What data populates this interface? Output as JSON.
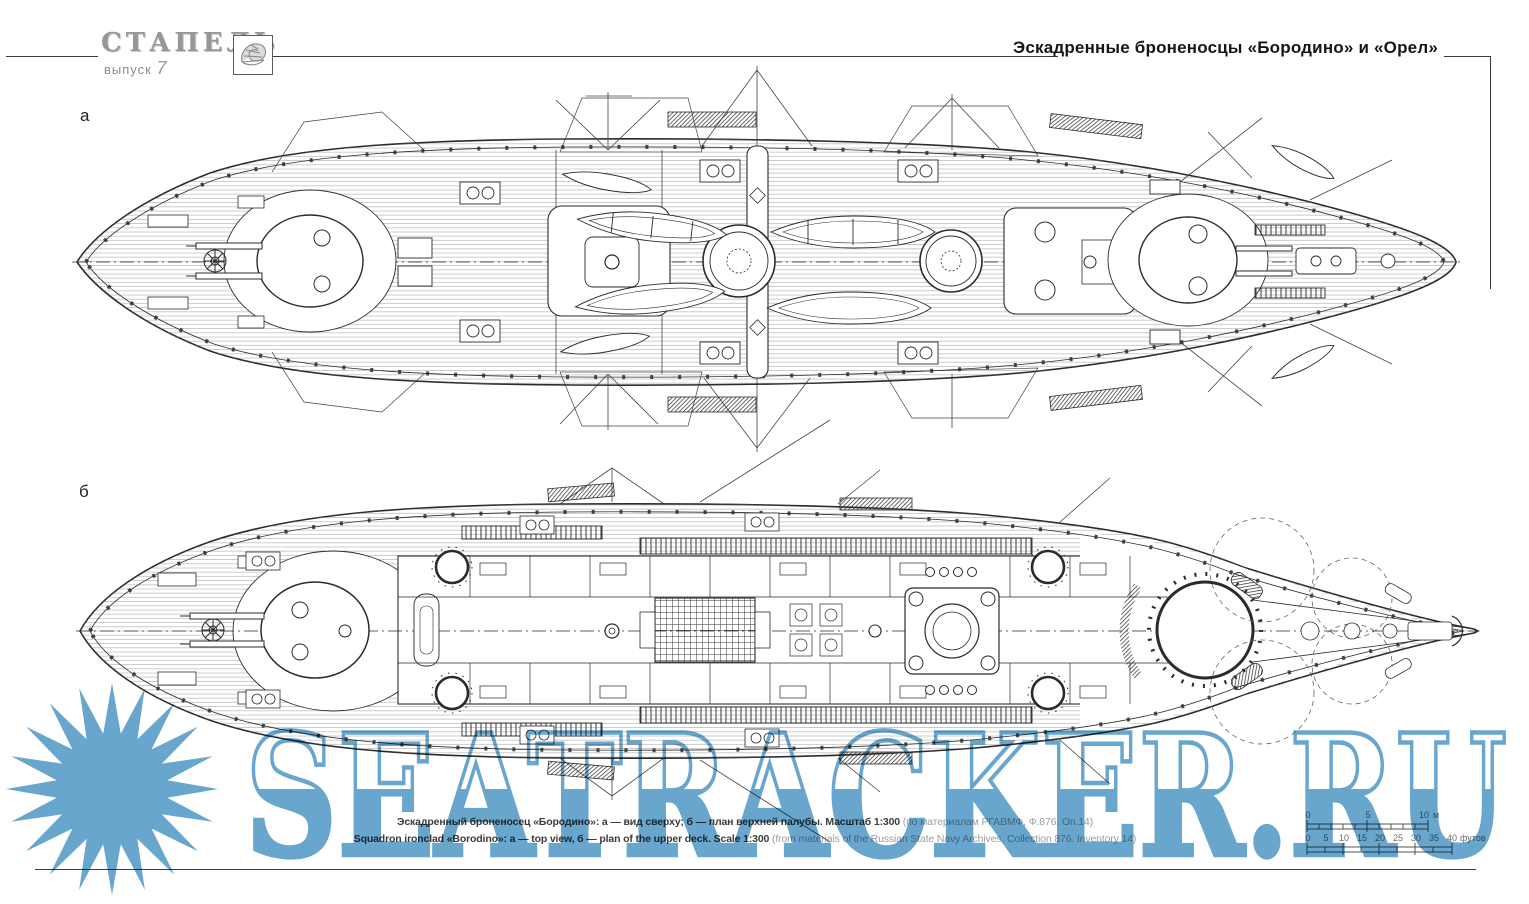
{
  "masthead": {
    "title": "СТАПЕЛЬ",
    "issue_label": "выпуск",
    "issue_number": "7"
  },
  "header": {
    "title": "Эскадренные броненосцы «Бородино» и «Орел»"
  },
  "figure": {
    "view_a_label": "а",
    "view_b_label": "б",
    "caption_ru_main": "Эскадренный броненосец «Бородино»: а — вид сверху; б — план верхней палубы. Масштаб 1:300 ",
    "caption_ru_source": "(по материалам РГАВМФ, Ф.876. Оп.14)",
    "caption_en_main": "Squadron ironclad «Borodino»: а — top view, б — plan of the upper deck. Scale 1:300 ",
    "caption_en_source": "(from materials of the Russian State Navy Archives, Collection 876. Inventory 14)"
  },
  "scale_bar": {
    "meters": {
      "t0": "0",
      "t1": "5",
      "t2": "10",
      "unit": "м"
    },
    "feet": {
      "t0": "0",
      "t1": "5",
      "t2": "10",
      "t3": "15",
      "t4": "20",
      "t5": "25",
      "t6": "30",
      "t7": "35",
      "t8": "40",
      "unit": "футов"
    }
  },
  "watermark": {
    "text": "SEATRACKER.RU",
    "color": "#5C9FC9"
  }
}
